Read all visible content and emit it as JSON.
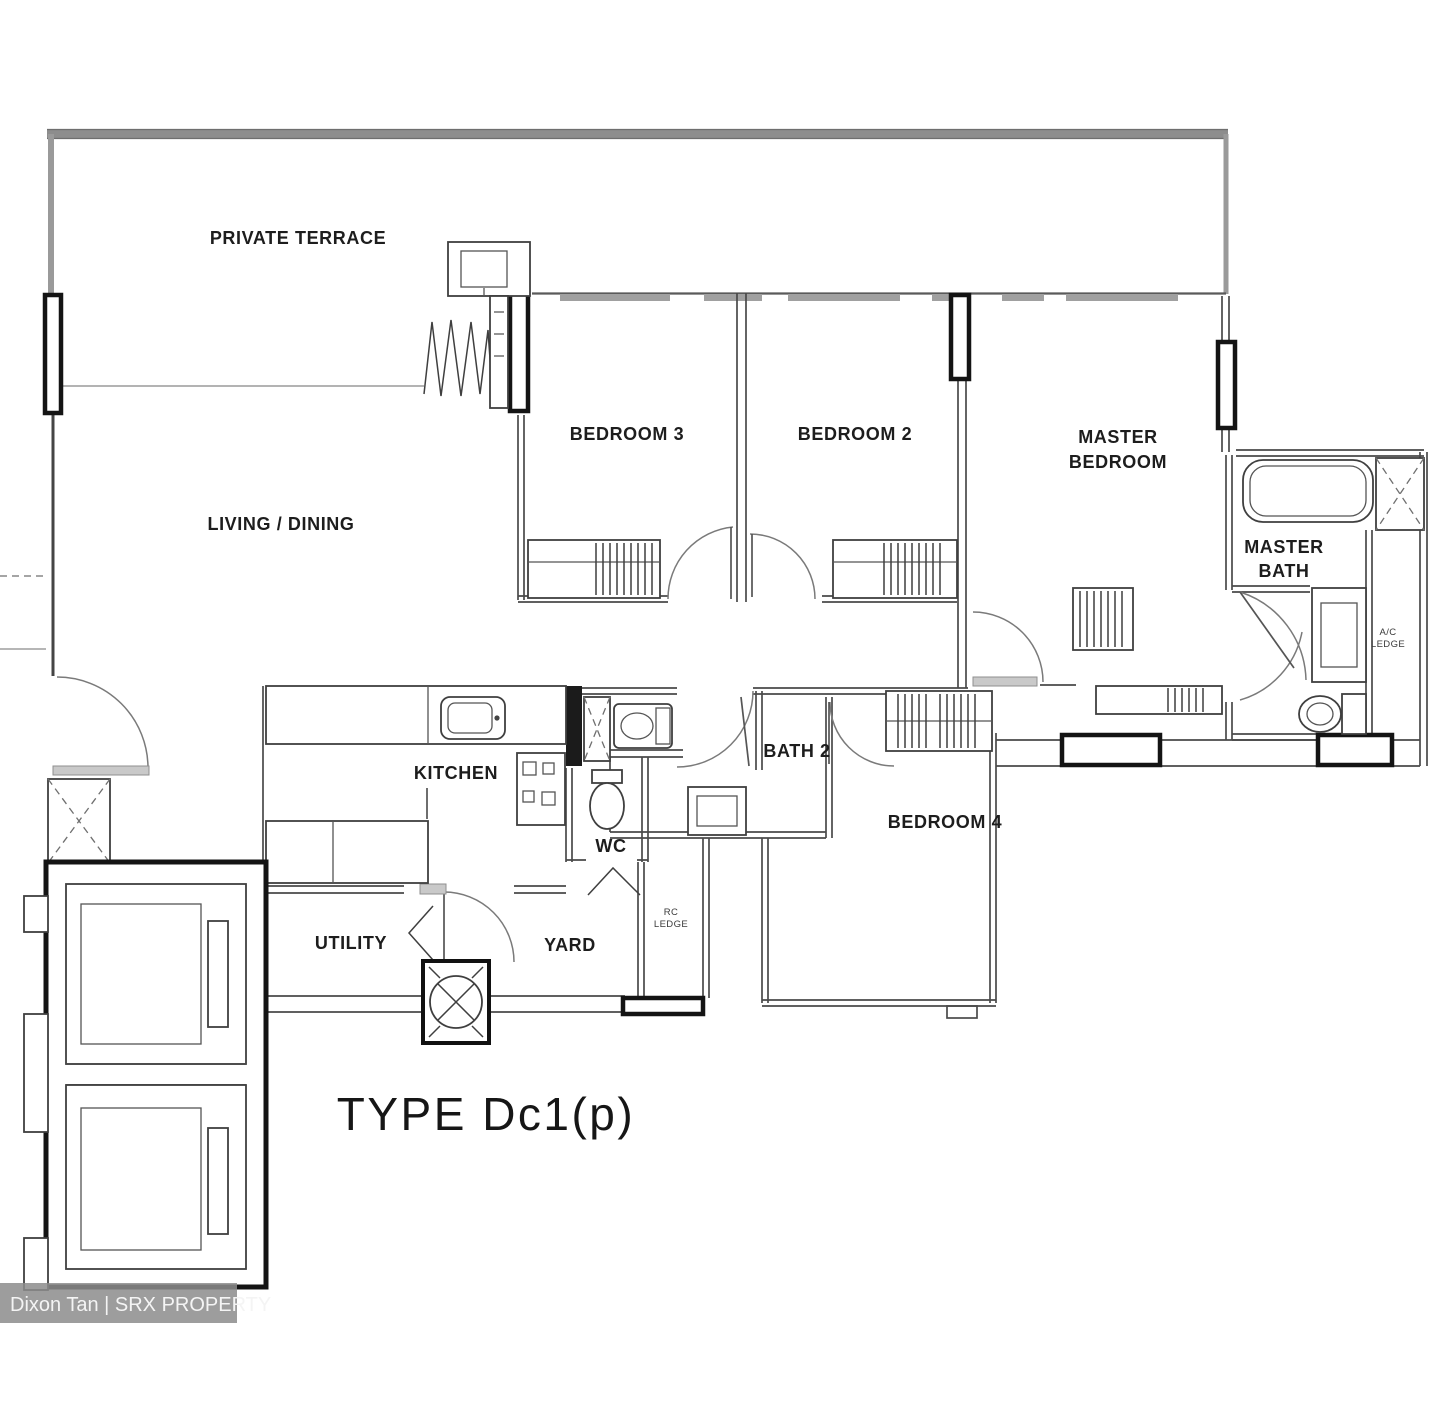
{
  "title": "TYPE Dc1(p)",
  "watermark": "Dixon Tan | SRX PROPERTY",
  "labels": {
    "private_terrace": "PRIVATE TERRACE",
    "living_dining": "LIVING / DINING",
    "bedroom3": "BEDROOM 3",
    "bedroom2": "BEDROOM 2",
    "master_bedroom_1": "MASTER",
    "master_bedroom_2": "BEDROOM",
    "master_bath_1": "MASTER",
    "master_bath_2": "BATH",
    "kitchen": "KITCHEN",
    "bath2": "BATH 2",
    "wc": "WC",
    "bedroom4": "BEDROOM 4",
    "utility": "UTILITY",
    "yard": "YARD",
    "ac_ledge_1": "A/C",
    "ac_ledge_2": "LEDGE",
    "rc_ledge_1": "RC",
    "rc_ledge_2": "LEDGE"
  },
  "colors": {
    "wall": "#454545",
    "window_frame": "#141414",
    "terrace_wall": "#8d8d8d",
    "label_text": "#1d1d1d",
    "watermark_bg": "#8c8c8c",
    "watermark_text": "#f4f4f4",
    "background": "#ffffff"
  }
}
